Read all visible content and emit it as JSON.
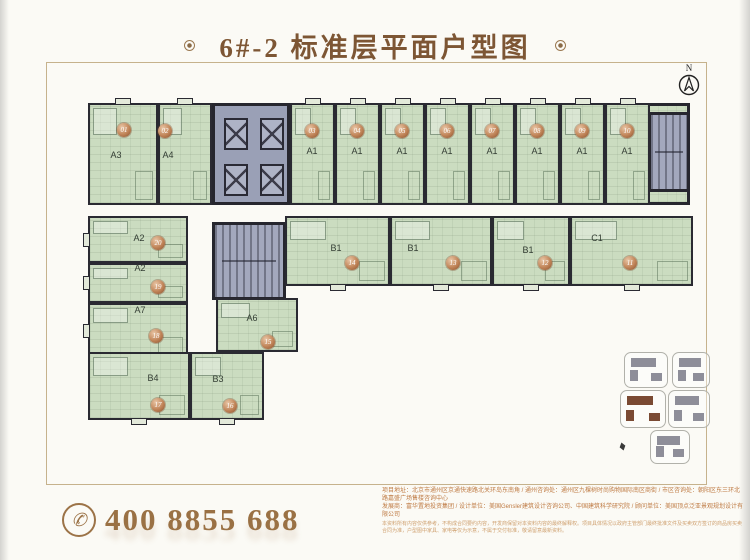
{
  "title": {
    "text": "6#-2 标准层平面户型图"
  },
  "compass": {
    "label": "N"
  },
  "icons": {
    "phone-icon": "✆",
    "north-arrow-icon": "compass-circle-arrow",
    "title-ornament": "ringed-dot"
  },
  "colors": {
    "accent_brown": "#7d5634",
    "phone_gold": "#9a7144",
    "info_orange": "#bf7b44",
    "room_green": "#cbdcc0",
    "wall_dark": "#26262e",
    "core_gray": "#9aa0b6",
    "badge_copper": "#c08458",
    "keyplan_highlight": "#7a4a33"
  },
  "plan": {
    "wings": [
      {
        "name": "top-wing",
        "x": 88,
        "y": 103,
        "w": 602,
        "h": 102
      },
      {
        "name": "middle-wing",
        "x": 285,
        "y": 216,
        "w": 408,
        "h": 70
      },
      {
        "name": "left-wing",
        "x": 88,
        "y": 216,
        "w": 100,
        "h": 142
      },
      {
        "name": "bottom-left-wing",
        "x": 88,
        "y": 352,
        "w": 176,
        "h": 68
      }
    ],
    "cores": [
      {
        "name": "elevator-core",
        "type": "elevator",
        "x": 212,
        "y": 103,
        "w": 78,
        "h": 102
      },
      {
        "name": "stair-core-top-right",
        "type": "stair",
        "x": 648,
        "y": 112,
        "w": 42,
        "h": 80
      },
      {
        "name": "stair-core-middle",
        "type": "stair",
        "x": 212,
        "y": 222,
        "w": 74,
        "h": 78
      }
    ],
    "units": [
      {
        "label": "A3",
        "badge": "01",
        "x": 88,
        "y": 103,
        "w": 70,
        "h": 102,
        "lx": 116,
        "ly": 155,
        "bx": 124,
        "by": 130,
        "notch": "top"
      },
      {
        "label": "A4",
        "badge": "02",
        "x": 158,
        "y": 103,
        "w": 54,
        "h": 102,
        "lx": 168,
        "ly": 155,
        "bx": 165,
        "by": 131,
        "notch": "top"
      },
      {
        "label": "A1",
        "badge": "03",
        "x": 290,
        "y": 103,
        "w": 45,
        "h": 102,
        "lx": 312,
        "ly": 151,
        "bx": 312,
        "by": 131,
        "notch": "top"
      },
      {
        "label": "A1",
        "badge": "04",
        "x": 335,
        "y": 103,
        "w": 45,
        "h": 102,
        "lx": 357,
        "ly": 151,
        "bx": 357,
        "by": 131,
        "notch": "top"
      },
      {
        "label": "A1",
        "badge": "05",
        "x": 380,
        "y": 103,
        "w": 45,
        "h": 102,
        "lx": 402,
        "ly": 151,
        "bx": 402,
        "by": 131,
        "notch": "top"
      },
      {
        "label": "A1",
        "badge": "06",
        "x": 425,
        "y": 103,
        "w": 45,
        "h": 102,
        "lx": 447,
        "ly": 151,
        "bx": 447,
        "by": 131,
        "notch": "top"
      },
      {
        "label": "A1",
        "badge": "07",
        "x": 470,
        "y": 103,
        "w": 45,
        "h": 102,
        "lx": 492,
        "ly": 151,
        "bx": 492,
        "by": 131,
        "notch": "top"
      },
      {
        "label": "A1",
        "badge": "08",
        "x": 515,
        "y": 103,
        "w": 45,
        "h": 102,
        "lx": 537,
        "ly": 151,
        "bx": 537,
        "by": 131,
        "notch": "top"
      },
      {
        "label": "A1",
        "badge": "09",
        "x": 560,
        "y": 103,
        "w": 45,
        "h": 102,
        "lx": 582,
        "ly": 151,
        "bx": 582,
        "by": 131,
        "notch": "top"
      },
      {
        "label": "A1",
        "badge": "10",
        "x": 605,
        "y": 103,
        "w": 45,
        "h": 102,
        "lx": 627,
        "ly": 151,
        "bx": 627,
        "by": 131,
        "notch": "top"
      },
      {
        "label": "B1",
        "badge": "14",
        "x": 285,
        "y": 216,
        "w": 105,
        "h": 70,
        "lx": 336,
        "ly": 248,
        "bx": 352,
        "by": 263,
        "notch": "bottom"
      },
      {
        "label": "B1",
        "badge": "13",
        "x": 390,
        "y": 216,
        "w": 102,
        "h": 70,
        "lx": 413,
        "ly": 248,
        "bx": 453,
        "by": 263,
        "notch": "bottom"
      },
      {
        "label": "B1",
        "badge": "12",
        "x": 492,
        "y": 216,
        "w": 78,
        "h": 70,
        "lx": 528,
        "ly": 250,
        "bx": 545,
        "by": 263,
        "notch": "bottom"
      },
      {
        "label": "C1",
        "badge": "11",
        "x": 570,
        "y": 216,
        "w": 123,
        "h": 70,
        "lx": 597,
        "ly": 238,
        "bx": 630,
        "by": 263,
        "notch": "bottom"
      },
      {
        "label": "A2",
        "badge": "20",
        "x": 88,
        "y": 216,
        "w": 100,
        "h": 47,
        "lx": 139,
        "ly": 238,
        "bx": 158,
        "by": 243,
        "notch": "left"
      },
      {
        "label": "A2",
        "badge": "19",
        "x": 88,
        "y": 263,
        "w": 100,
        "h": 40,
        "lx": 140,
        "ly": 268,
        "bx": 158,
        "by": 287,
        "notch": "left"
      },
      {
        "label": "A7",
        "badge": "18",
        "x": 88,
        "y": 303,
        "w": 100,
        "h": 55,
        "lx": 140,
        "ly": 310,
        "bx": 156,
        "by": 336,
        "notch": "left"
      },
      {
        "label": "B4",
        "badge": "17",
        "x": 88,
        "y": 352,
        "w": 102,
        "h": 68,
        "lx": 153,
        "ly": 378,
        "bx": 158,
        "by": 405,
        "notch": "bottom"
      },
      {
        "label": "B3",
        "badge": "16",
        "x": 190,
        "y": 352,
        "w": 74,
        "h": 68,
        "lx": 218,
        "ly": 379,
        "bx": 230,
        "by": 406,
        "notch": "bottom"
      },
      {
        "label": "A6",
        "badge": "15",
        "x": 216,
        "y": 298,
        "w": 82,
        "h": 54,
        "lx": 252,
        "ly": 318,
        "bx": 268,
        "by": 342,
        "notch": null
      }
    ]
  },
  "key_plan": {
    "blocks": [
      {
        "x": 624,
        "y": 352,
        "w": 42,
        "h": 34,
        "highlighted": false
      },
      {
        "x": 672,
        "y": 352,
        "w": 36,
        "h": 34,
        "highlighted": false
      },
      {
        "x": 620,
        "y": 390,
        "w": 44,
        "h": 36,
        "highlighted": true
      },
      {
        "x": 668,
        "y": 390,
        "w": 40,
        "h": 36,
        "highlighted": false
      },
      {
        "x": 650,
        "y": 430,
        "w": 38,
        "h": 32,
        "highlighted": false
      }
    ]
  },
  "footer": {
    "phone": "400 8855 688",
    "info_line1": "项目地址：北京市通州区京通快速路北关环岛东南角 / 通州咨询处：通州区九棵树时尚购物国际南区商街 / 市区咨询处：朝阳区东三环北路嘉盛广场售楼咨询中心",
    "info_line2": "发展商：富华置地投资集团 / 设计单位：美国Gensler建筑设计咨询公司、中国建筑科学研究院 / 顾问单位：美国顶点泛亚景观规划设计有限公司",
    "disclaimer": "本资料所有内容仅供参考，不构成合同要约内容，开发商保留对本资料内容的最终解释权。项目具体情况以政府主管部门最终批准文件及买卖双方签订的商品房买卖合同为准，户型图中家具、家电等仅为示意，不属于交付标准，敬请留意最新资料。"
  }
}
